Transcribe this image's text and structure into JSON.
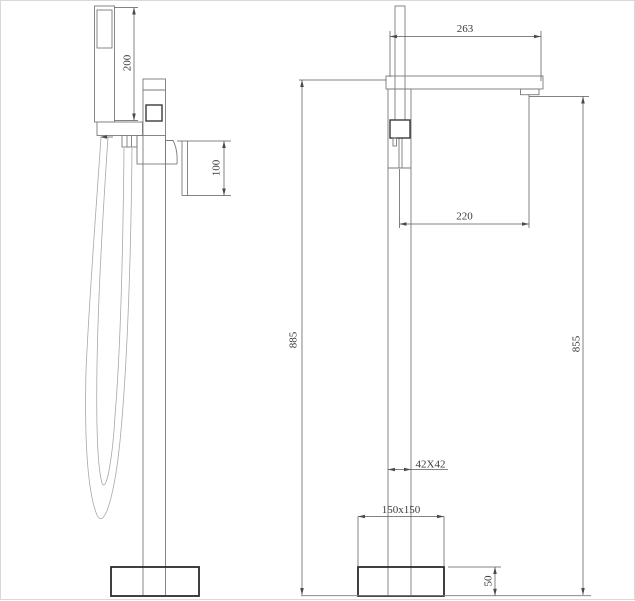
{
  "drawing_type": "technical-dimension-drawing",
  "dimensions": {
    "shower_height": "200",
    "handle_drop": "100",
    "spout_reach": "263",
    "spout_outlet_offset": "220",
    "overall_height": "885",
    "outlet_height": "855",
    "column_section": "42X42",
    "base_plate": "150x150",
    "base_height": "50"
  },
  "colors": {
    "background": "#ffffff",
    "object_line": "#7a7a7a",
    "bold_line": "#2b2b2b",
    "dimension_line": "#5a5a5a",
    "text": "#3a3a3a"
  }
}
